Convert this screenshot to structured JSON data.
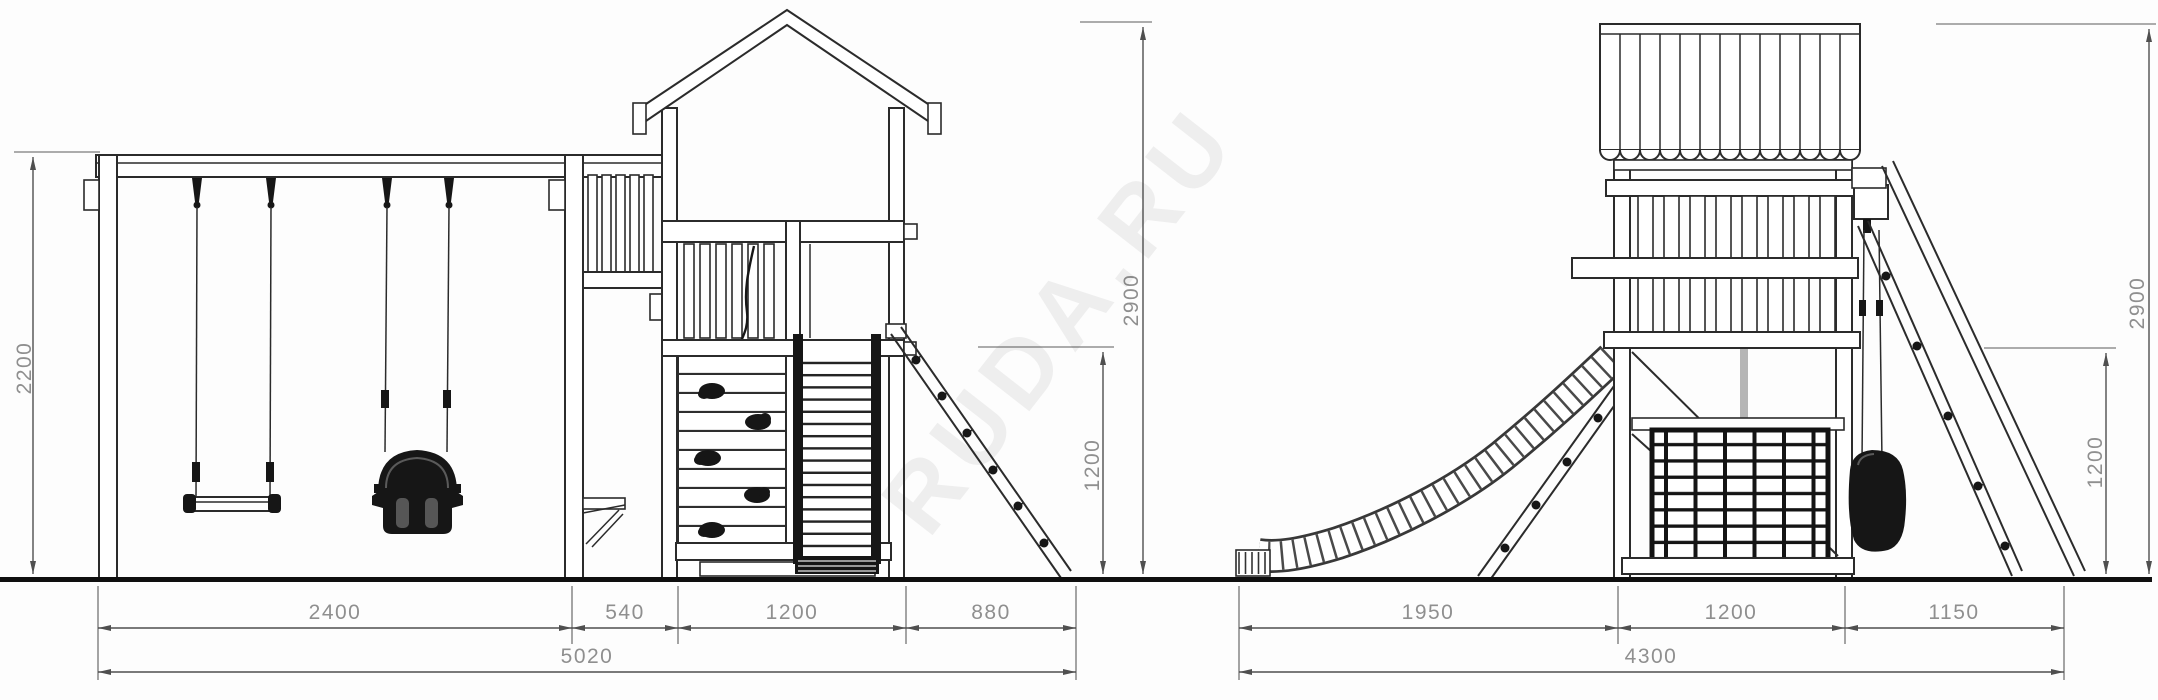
{
  "front_view": {
    "width_swing": "2400",
    "width_gap": "540",
    "width_tower": "1200",
    "width_ladder": "880",
    "width_total": "5020",
    "height_swing_frame": "2200",
    "height_deck": "1200",
    "height_overall": "2900"
  },
  "side_view": {
    "width_slide": "1950",
    "width_tower": "1200",
    "width_frame": "1150",
    "width_total": "4300",
    "height_deck": "1200",
    "height_overall": "2900"
  },
  "watermark": "RUDA.RU",
  "line_color": "#2b2b2b",
  "dim_text_color": "#8f8f8f",
  "background_color": "#fdfdfd"
}
